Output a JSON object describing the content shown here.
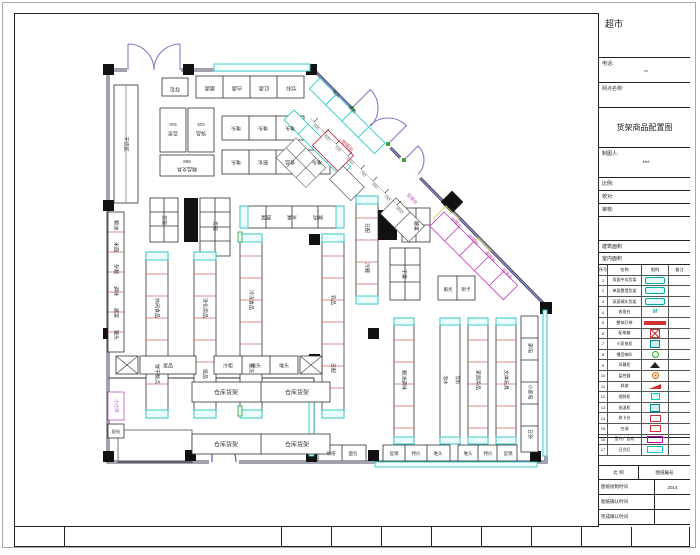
{
  "colors": {
    "wall": "#44445e",
    "cyan": "#2fc9c9",
    "red": "#cc3344",
    "magenta": "#c050c0",
    "purple": "#7d7dc8",
    "blue": "#4a4ac8",
    "green": "#3aa83a",
    "yellow": "#d6d65a",
    "column": "#111111"
  },
  "title_block": {
    "project": "超市",
    "phone_label": "电话:",
    "phone_value": "**",
    "site_label": "网点名称:",
    "drawing_title": "货架商品配置图",
    "drafter_label": "制图人:",
    "drafter_value": "***",
    "scale_label": "比例:",
    "check_label": "校对:",
    "review_label": "审核:",
    "area1_label": "建筑面积",
    "area2_label": "室内面积",
    "bottom": {
      "scale": "比 例",
      "num": "图纸编号",
      "r1": "图纸绘制时间",
      "r1v": "2014",
      "r2": "图纸确认时间",
      "r2v": "",
      "r3": "完成确认时间",
      "r3v": ""
    }
  },
  "legend": {
    "headers": [
      "序号",
      "名称",
      "图例",
      "备注"
    ],
    "rows": [
      {
        "no": "1",
        "name": "双面中岛货架",
        "sym": "pill",
        "st": ""
      },
      {
        "no": "2",
        "name": "单面靠墙货架",
        "sym": "pill",
        "st": ""
      },
      {
        "no": "3",
        "name": "双面端头货架",
        "sym": "pill",
        "st": ""
      },
      {
        "no": "4",
        "name": "收银台",
        "sym": "txtM",
        "st": "M"
      },
      {
        "no": "5",
        "name": "整体灯带",
        "sym": "bar-red",
        "st": ""
      },
      {
        "no": "6",
        "name": "配电箱",
        "sym": "box-x-red",
        "st": ""
      },
      {
        "no": "7",
        "name": "小家电柜",
        "sym": "rect-teal",
        "st": ""
      },
      {
        "no": "8",
        "name": "播音喇叭",
        "sym": "circle-green",
        "st": ""
      },
      {
        "no": "9",
        "name": "风幕柜",
        "sym": "tri-black",
        "st": ""
      },
      {
        "no": "10",
        "name": "监控器",
        "sym": "circle-orange",
        "st": ""
      },
      {
        "no": "11",
        "name": "斜坡",
        "sym": "wedge-red",
        "st": ""
      },
      {
        "no": "12",
        "name": "保鲜柜",
        "sym": "rect-cyan-s",
        "st": ""
      },
      {
        "no": "13",
        "name": "低温柜",
        "sym": "rect-teal",
        "st": ""
      },
      {
        "no": "14",
        "name": "收卡台",
        "sym": "box-red-s",
        "st": ""
      },
      {
        "no": "15",
        "name": "空调",
        "sym": "box-red-s",
        "st": ""
      },
      {
        "no": "16",
        "name": "室内广告机",
        "sym": "box-magenta",
        "st": ""
      },
      {
        "no": "17",
        "name": "日光灯",
        "sym": "box-cyan",
        "st": ""
      }
    ]
  },
  "plan": {
    "labels": [
      {
        "t": "存包",
        "x": 175,
        "y": 89,
        "r": 180
      },
      {
        "t": "烟酒",
        "x": 210,
        "y": 88,
        "r": 180
      },
      {
        "t": "白酒",
        "x": 237,
        "y": 88,
        "r": 180
      },
      {
        "t": "红酒",
        "x": 264,
        "y": 88,
        "r": 180
      },
      {
        "t": "饮料",
        "x": 291,
        "y": 88,
        "r": 180
      },
      {
        "t": "916",
        "x": 173,
        "y": 124,
        "r": 180,
        "s": 4.5
      },
      {
        "t": "百货",
        "x": 173,
        "y": 133,
        "r": 180
      },
      {
        "t": "915",
        "x": 201,
        "y": 124,
        "r": 180,
        "s": 4.5
      },
      {
        "t": "饰品",
        "x": 201,
        "y": 133,
        "r": 180
      },
      {
        "t": "908",
        "x": 187,
        "y": 161,
        "r": 180,
        "s": 4.5
      },
      {
        "t": "精品文具",
        "x": 187,
        "y": 169,
        "r": 180
      },
      {
        "t": "堆头",
        "x": 236,
        "y": 128,
        "r": 180
      },
      {
        "t": "堆头",
        "x": 263,
        "y": 128,
        "r": 180
      },
      {
        "t": "堆头",
        "x": 290,
        "y": 128,
        "r": 180
      },
      {
        "t": "堆头",
        "x": 236,
        "y": 162,
        "r": 180
      },
      {
        "t": "膨化",
        "x": 263,
        "y": 162,
        "r": 180
      },
      {
        "t": "食品",
        "x": 290,
        "y": 162,
        "r": 180
      },
      {
        "t": "堆头",
        "x": 317,
        "y": 162,
        "r": 180
      },
      {
        "t": "干货区",
        "x": 126,
        "y": 144,
        "r": 90
      },
      {
        "t": "粮油",
        "x": 116,
        "y": 225,
        "r": 90
      },
      {
        "t": "米面",
        "x": 116,
        "y": 247,
        "r": 90
      },
      {
        "t": "杂粮",
        "x": 116,
        "y": 269,
        "r": 90
      },
      {
        "t": "调味",
        "x": 116,
        "y": 291,
        "r": 90
      },
      {
        "t": "酱菜",
        "x": 116,
        "y": 313,
        "r": 90
      },
      {
        "t": "罐头",
        "x": 116,
        "y": 335,
        "r": 90
      },
      {
        "t": "货架",
        "x": 164,
        "y": 220,
        "r": 90
      },
      {
        "t": "货架",
        "x": 215,
        "y": 226,
        "r": 90
      },
      {
        "t": "休闲食品",
        "x": 157,
        "y": 308,
        "r": 90
      },
      {
        "t": "饼干糕点",
        "x": 157,
        "y": 374,
        "r": 90
      },
      {
        "t": "洗化用品",
        "x": 205,
        "y": 308,
        "r": 90
      },
      {
        "t": "纸品",
        "x": 205,
        "y": 374,
        "r": 90
      },
      {
        "t": "蔬菜",
        "x": 266,
        "y": 217,
        "r": 180
      },
      {
        "t": "水果",
        "x": 292,
        "y": 217,
        "r": 180
      },
      {
        "t": "鲜肉",
        "x": 318,
        "y": 217,
        "r": 180
      },
      {
        "t": "冷冻食品",
        "x": 251,
        "y": 300,
        "r": 90
      },
      {
        "t": "速冻",
        "x": 251,
        "y": 368,
        "r": 90
      },
      {
        "t": "乳品",
        "x": 333,
        "y": 300,
        "r": 90
      },
      {
        "t": "日配",
        "x": 333,
        "y": 368,
        "r": 90
      },
      {
        "t": "日配",
        "x": 367,
        "y": 228,
        "r": 90
      },
      {
        "t": "冷藏",
        "x": 367,
        "y": 268,
        "r": 90
      },
      {
        "t": "糖果",
        "x": 416,
        "y": 226,
        "r": 90
      },
      {
        "t": "干果",
        "x": 404,
        "y": 274,
        "r": 90
      },
      {
        "t": "服务",
        "x": 448,
        "y": 290,
        "s": 4.5
      },
      {
        "t": "制卡",
        "x": 466,
        "y": 290,
        "s": 4.5
      },
      {
        "t": "粮油调味",
        "x": 404,
        "y": 380,
        "r": 90
      },
      {
        "t": "酒水",
        "x": 445,
        "y": 380,
        "r": 90,
        "s": 4.5
      },
      {
        "t": "饮料",
        "x": 457,
        "y": 380,
        "r": 90,
        "s": 4.5
      },
      {
        "t": "家居用品",
        "x": 478,
        "y": 380,
        "r": 90
      },
      {
        "t": "文体玩具",
        "x": 506,
        "y": 380,
        "r": 90
      },
      {
        "t": "家电",
        "x": 530,
        "y": 348,
        "r": 90
      },
      {
        "t": "小家电",
        "x": 530,
        "y": 392,
        "r": 90
      },
      {
        "t": "日杂",
        "x": 530,
        "y": 434,
        "r": 90
      },
      {
        "t": "蛋品",
        "x": 168,
        "y": 366
      },
      {
        "t": "冷柜",
        "x": 228,
        "y": 366
      },
      {
        "t": "堆头",
        "x": 256,
        "y": 366
      },
      {
        "t": "堆头",
        "x": 284,
        "y": 366
      },
      {
        "t": "小仓库",
        "x": 116,
        "y": 406,
        "r": 90,
        "c": "#c050c0",
        "s": 4.5
      },
      {
        "t": "配电",
        "x": 116,
        "y": 432,
        "s": 4
      },
      {
        "t": "仓库货架",
        "x": 226,
        "y": 393,
        "s": 6
      },
      {
        "t": "仓库货架",
        "x": 297,
        "y": 393,
        "s": 6
      },
      {
        "t": "仓库货架",
        "x": 226,
        "y": 445,
        "s": 6
      },
      {
        "t": "仓库货架",
        "x": 297,
        "y": 445,
        "s": 6
      },
      {
        "t": "烘焙",
        "x": 331,
        "y": 454,
        "s": 4.5
      },
      {
        "t": "面包",
        "x": 353,
        "y": 454,
        "s": 4.5
      },
      {
        "t": "促销",
        "x": 394,
        "y": 454,
        "s": 4.5
      },
      {
        "t": "特价",
        "x": 416,
        "y": 454,
        "s": 4.5
      },
      {
        "t": "堆头",
        "x": 438,
        "y": 454,
        "s": 4.5
      },
      {
        "t": "堆头",
        "x": 468,
        "y": 454,
        "s": 4.5
      },
      {
        "t": "特价",
        "x": 488,
        "y": 454,
        "s": 4.5
      },
      {
        "t": "促销",
        "x": 508,
        "y": 454,
        "s": 4.5
      },
      {
        "t": "收银台",
        "x": 347,
        "y": 146,
        "r": 45,
        "c": "#cc3344",
        "s": 5
      },
      {
        "t": "促销台",
        "x": 412,
        "y": 199,
        "r": 45,
        "c": "#c050c0",
        "s": 4.5
      },
      {
        "t": "收银台",
        "x": 456,
        "y": 223,
        "r": 45,
        "c": "#c050c0",
        "s": 4.5
      },
      {
        "t": "收银台",
        "x": 473,
        "y": 240,
        "r": 45,
        "c": "#c050c0",
        "s": 4.5
      },
      {
        "t": "收银台",
        "x": 490,
        "y": 257,
        "r": 45,
        "c": "#c050c0",
        "s": 4.5
      },
      {
        "t": "包装台",
        "x": 507,
        "y": 274,
        "r": 45,
        "c": "#c050c0",
        "s": 4.5
      },
      {
        "t": "堆头",
        "x": 336,
        "y": 94,
        "r": 45,
        "s": 4.5
      },
      {
        "t": "特价",
        "x": 352,
        "y": 110,
        "r": 45,
        "s": 4.5
      },
      {
        "t": "600",
        "x": 316,
        "y": 127,
        "r": 45,
        "c": "#666",
        "s": 4
      },
      {
        "t": "600",
        "x": 327,
        "y": 138,
        "r": 45,
        "c": "#666",
        "s": 4
      },
      {
        "t": "600",
        "x": 338,
        "y": 149,
        "r": 45,
        "c": "#666",
        "s": 4
      },
      {
        "t": "1360",
        "x": 350,
        "y": 161,
        "r": 45,
        "c": "#666",
        "s": 4
      },
      {
        "t": "750",
        "x": 363,
        "y": 174,
        "r": 45,
        "c": "#666",
        "s": 4
      },
      {
        "t": "850",
        "x": 375,
        "y": 186,
        "r": 45,
        "c": "#666",
        "s": 4
      },
      {
        "t": "150",
        "x": 387,
        "y": 198,
        "r": 45,
        "c": "#666",
        "s": 4
      },
      {
        "t": "1800",
        "x": 399,
        "y": 210,
        "r": 45,
        "c": "#666",
        "s": 4
      }
    ]
  }
}
